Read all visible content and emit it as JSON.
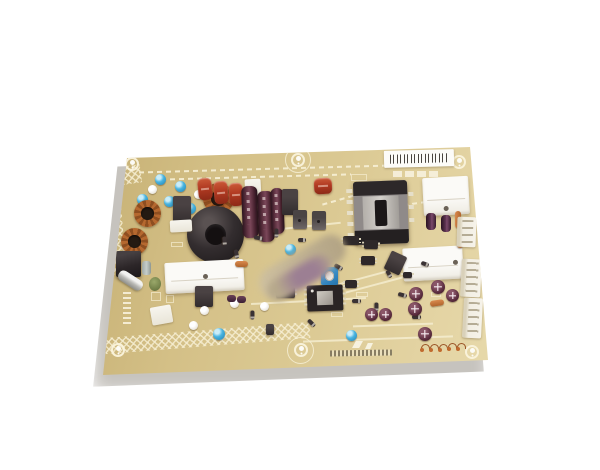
{
  "scene": {
    "description": "Product photograph of a beige TV power-supply printed circuit board, tilted slightly, on a plain white background with a soft shadow",
    "background_color": "#ffffff"
  },
  "board": {
    "substrate_color": "#d6c287",
    "silkscreen_color": "#f1e7c3",
    "shadow_color": "rgba(105,98,85,0.38)",
    "labels": {
      "barcode_label": "white adhesive label with black barcode at top right, characters not legible",
      "silkscreen_part_numbers": "small white silkscreen markings at left edge and bottom edge, not legible",
      "privacy_blur": "center sticker area blurred out"
    },
    "component_colors": {
      "film_capacitor_red": "#b13a22",
      "copper_winding": "#a65c29",
      "electrolytic_maroon": "#5d3140",
      "capacitor_blue": "#49b4e0",
      "heatsink_white": "#f7f5f0",
      "connector_white": "#f3efe4",
      "transformer_black": "#2d2829",
      "transformer_frame_gray": "#8f8a89",
      "choke_black": "#2b2527",
      "green_disc": "#6f7d46",
      "orange_resistor": "#c5763a"
    },
    "component_inventory": {
      "switching_transformer": 1,
      "black_toroidal_choke": 1,
      "copper_toroid_inductors": 3,
      "white_heatsink_plates": 3,
      "red_film_capacitors": 4,
      "large_maroon_electrolytic_capacitors": 3,
      "small_maroon_electrolytic_capacitors": 11,
      "blue_electrolytic_capacitors": 8,
      "white_edge_connectors": 3,
      "blue_trimmer_potentiometer": 1,
      "ics_black": 6,
      "transistors": 6,
      "glass_fuse": 1,
      "green_disc_capacitor": 1,
      "mounting_hole_markings": 6
    }
  }
}
